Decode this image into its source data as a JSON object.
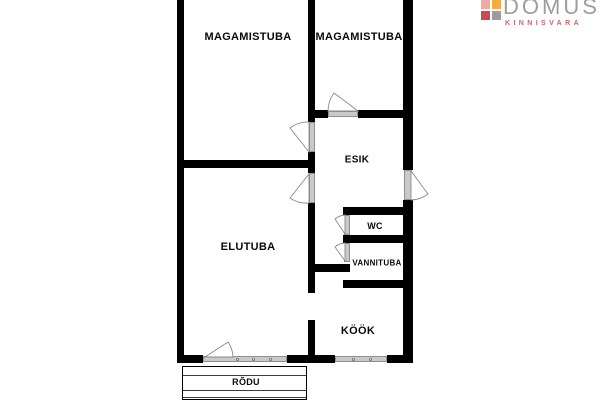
{
  "logo": {
    "brand": "DOMUS",
    "tagline": "KINNISVARA",
    "brand_color": "#9d9d9d",
    "tagline_color": "#c4686b",
    "squares": [
      {
        "name": "square-top-left",
        "color": "#efa9a0",
        "x": 0,
        "y": 0
      },
      {
        "name": "square-top-right",
        "color": "#f5ab43",
        "x": 11,
        "y": 0
      },
      {
        "name": "square-bottom-left",
        "color": "#c94a52",
        "x": 0,
        "y": 11
      },
      {
        "name": "square-bottom-right",
        "color": "#9c9c9c",
        "x": 11,
        "y": 11
      }
    ]
  },
  "plan": {
    "wall_color": "#000000",
    "door_frame_color": "#c9c9c9",
    "arc_color": "#8a8a8a",
    "rooms": [
      {
        "id": "magamistuba-1",
        "label": "MAGAMISTUBA",
        "cx": 248,
        "cy": 37,
        "fs": 11
      },
      {
        "id": "magamistuba-2",
        "label": "MAGAMISTUBA",
        "cx": 359,
        "cy": 37,
        "fs": 11
      },
      {
        "id": "esik",
        "label": "ESIK",
        "cx": 357,
        "cy": 160,
        "fs": 10
      },
      {
        "id": "wc",
        "label": "WC",
        "cx": 375,
        "cy": 226,
        "fs": 9
      },
      {
        "id": "vannituba",
        "label": "VANNITUBA",
        "cx": 377,
        "cy": 263,
        "fs": 8
      },
      {
        "id": "elutuba",
        "label": "ELUTUBA",
        "cx": 248,
        "cy": 247,
        "fs": 11
      },
      {
        "id": "kook",
        "label": "KÖÖK",
        "cx": 358,
        "cy": 331,
        "fs": 11
      },
      {
        "id": "rodu",
        "label": "RÕDU",
        "cx": 246,
        "cy": 382,
        "fs": 9,
        "bg": true
      }
    ],
    "walls": [
      {
        "id": "left-outer-wall",
        "x": 177,
        "y": 0,
        "w": 7,
        "h": 363
      },
      {
        "id": "middle-wall-top",
        "x": 308,
        "y": 0,
        "w": 7,
        "h": 122
      },
      {
        "id": "middle-wall-mid",
        "x": 308,
        "y": 152,
        "w": 7,
        "h": 21
      },
      {
        "id": "middle-wall-lower",
        "x": 308,
        "y": 203,
        "w": 7,
        "h": 90
      },
      {
        "id": "middle-wall-bottom",
        "x": 308,
        "y": 320,
        "w": 7,
        "h": 43
      },
      {
        "id": "right-outer-wall-top",
        "x": 403,
        "y": 0,
        "w": 10,
        "h": 170
      },
      {
        "id": "right-outer-wall-bottom",
        "x": 403,
        "y": 200,
        "w": 10,
        "h": 163
      },
      {
        "id": "bedroom2-bottom-wall-left",
        "x": 315,
        "y": 110,
        "w": 13,
        "h": 8
      },
      {
        "id": "bedroom2-bottom-wall-right",
        "x": 358,
        "y": 110,
        "w": 45,
        "h": 8
      },
      {
        "id": "bedroom1-bottom-wall",
        "x": 177,
        "y": 160,
        "w": 138,
        "h": 8
      },
      {
        "id": "esik-bottom-wall",
        "x": 343,
        "y": 207,
        "w": 70,
        "h": 8
      },
      {
        "id": "wc-vannituba-divider-wall",
        "x": 343,
        "y": 235,
        "w": 60,
        "h": 8
      },
      {
        "id": "corridor-stub-wall",
        "x": 313,
        "y": 264,
        "w": 37,
        "h": 8
      },
      {
        "id": "vannituba-bottom-wall",
        "x": 343,
        "y": 280,
        "w": 70,
        "h": 8
      },
      {
        "id": "bottom-wall-left",
        "x": 177,
        "y": 355,
        "w": 26,
        "h": 8
      },
      {
        "id": "bottom-wall-middle",
        "x": 287,
        "y": 355,
        "w": 48,
        "h": 8
      },
      {
        "id": "bottom-wall-right",
        "x": 387,
        "y": 355,
        "w": 26,
        "h": 8
      }
    ],
    "door_frames": [
      {
        "id": "bedroom2-door-frame",
        "x": 328,
        "y": 111,
        "w": 30,
        "h": 6
      },
      {
        "id": "bedroom1-door-frame",
        "x": 309,
        "y": 122,
        "w": 6,
        "h": 30
      },
      {
        "id": "elutuba-door-frame",
        "x": 309,
        "y": 173,
        "w": 6,
        "h": 30
      },
      {
        "id": "entrance-door-frame",
        "x": 404,
        "y": 170,
        "w": 8,
        "h": 30
      },
      {
        "id": "wc-door-frame",
        "x": 344,
        "y": 215,
        "w": 6,
        "h": 20
      },
      {
        "id": "vannituba-door-frame",
        "x": 344,
        "y": 243,
        "w": 6,
        "h": 19
      },
      {
        "id": "balcony-door-window-frame",
        "x": 203,
        "y": 356,
        "w": 84,
        "h": 6
      },
      {
        "id": "kook-window-frame",
        "x": 335,
        "y": 356,
        "w": 52,
        "h": 6
      }
    ],
    "door_arcs": [
      {
        "id": "bedroom2-door-arc",
        "path": "M 358 111 L 334 93 A 31 31 0 0 0 328 111 Z"
      },
      {
        "id": "bedroom1-door-arc",
        "path": "M 309 152 L 290 128 A 30 30 0 0 1 309 122 Z"
      },
      {
        "id": "elutuba-door-arc",
        "path": "M 309 174 L 290 198 A 29 29 0 0 0 309 203 Z"
      },
      {
        "id": "entrance-door-arc",
        "path": "M 411 171 L 428 194 A 29 29 0 0 1 411 200 Z"
      },
      {
        "id": "wc-door-arc",
        "path": "M 345 234 L 335 219 A 18 18 0 0 1 345 215 Z"
      },
      {
        "id": "vannituba-door-arc",
        "path": "M 345 261 L 335 247 A 17 17 0 0 1 345 243 Z"
      },
      {
        "id": "balcony-door-arc",
        "path": "M 205 357 L 228 342 A 27 27 0 0 1 233 357 Z"
      }
    ],
    "window_dots": [
      {
        "x": 237,
        "y": 359
      },
      {
        "x": 253,
        "y": 359
      },
      {
        "x": 270,
        "y": 359
      },
      {
        "x": 353,
        "y": 359
      },
      {
        "x": 370,
        "y": 359
      }
    ],
    "balcony": {
      "x": 182,
      "y": 366,
      "w": 125,
      "h": 34,
      "lines": [
        8,
        23,
        30
      ]
    }
  }
}
